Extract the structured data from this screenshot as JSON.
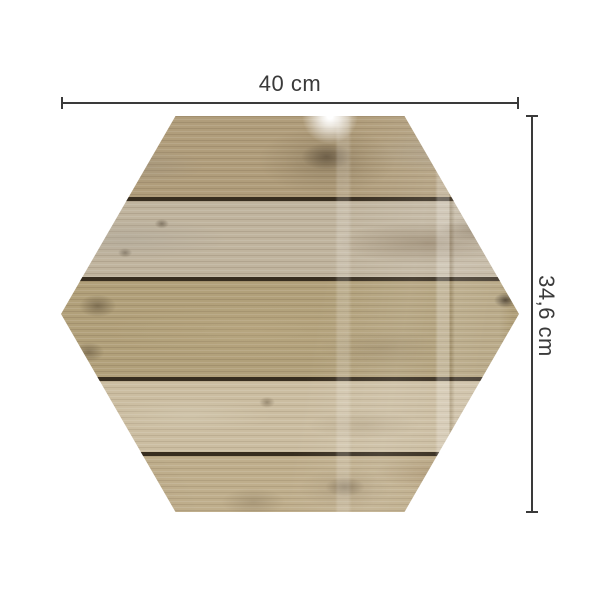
{
  "image": {
    "background": "#ffffff",
    "description_labels_only": true
  },
  "dimensions": {
    "width_label": "40 cm",
    "height_label": "34,6 cm",
    "line_color": "#3a3a3a",
    "text_color": "#3a3a3a"
  },
  "board": {
    "shape": "hexagon",
    "surface": "glossy wood planks",
    "gap_color": "#372d1f",
    "planks": [
      {
        "height_px": 81,
        "color": "#b09d7b"
      },
      {
        "height_px": 80,
        "color": "#c0b49e"
      },
      {
        "height_px": 100,
        "color": "#b1a07a"
      },
      {
        "height_px": 75,
        "color": "#cbbda1"
      },
      {
        "height_px": 60,
        "color": "#bfae8c"
      }
    ]
  }
}
